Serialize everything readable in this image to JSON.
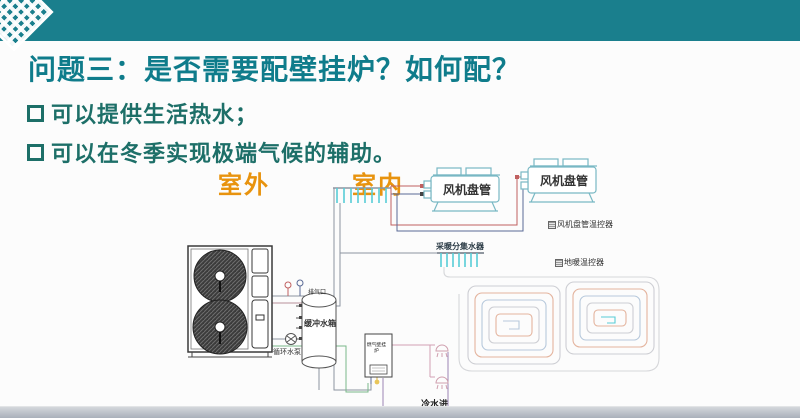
{
  "slide": {
    "title": "问题三：是否需要配壁挂炉？如何配？",
    "bullets": [
      {
        "text": "可以提供生活热水；"
      },
      {
        "text": "可以在冬季实现极端气候的辅助。"
      }
    ],
    "zones": {
      "outdoor": "室外",
      "indoor": "室内"
    }
  },
  "diagram": {
    "fan_coil_1": "风机盘管",
    "fan_coil_2": "风机盘管",
    "fan_coil_thermostat": "风机盘管温控器",
    "floor_thermostat": "地暖温控器",
    "heating_manifold": "采暖分集水器",
    "exhaust_port": "排气口",
    "buffer_tank": "缓冲水箱",
    "circulation_pump": "循环水泵",
    "boiler": "燃气壁挂炉",
    "cold_water_inlet": "冷水进"
  },
  "colors": {
    "accent_teal": "#1a7f8d",
    "title_teal": "#0f7c8b",
    "bullet_teal": "#1d6f68",
    "zone_orange": "#e8930e",
    "pipe_red": "#c06060",
    "pipe_blue": "#5a6a96",
    "pipe_cyan": "#58cdd6",
    "pipe_green": "#7ab88a",
    "pipe_purple": "#9b85b5",
    "pipe_pink": "#d2a0b4"
  }
}
